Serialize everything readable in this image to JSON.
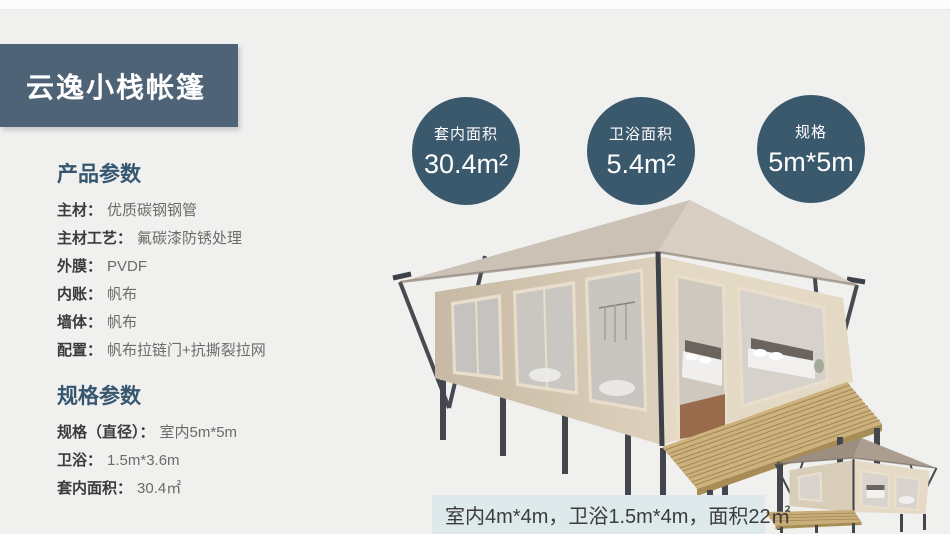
{
  "title": {
    "text": "云逸小栈帐篷"
  },
  "specs": {
    "sections": [
      {
        "heading": "产品参数",
        "rows": [
          {
            "label": "主材：",
            "value": "优质碳钢钢管"
          },
          {
            "label": "主材工艺：",
            "value": "氟碳漆防锈处理"
          },
          {
            "label": "外膜：",
            "value": "PVDF"
          },
          {
            "label": "内账：",
            "value": "帆布"
          },
          {
            "label": "墙体：",
            "value": "帆布"
          },
          {
            "label": "配置：",
            "value": "帆布拉链门+抗撕裂拉网"
          }
        ]
      },
      {
        "heading": "规格参数",
        "rows": [
          {
            "label": "规格（直径）：",
            "value": "室内5m*5m"
          },
          {
            "label": "卫浴：",
            "value": "1.5m*3.6m"
          },
          {
            "label": "套内面积：",
            "value": "30.4㎡"
          }
        ]
      }
    ]
  },
  "badges": {
    "items": [
      {
        "label": "套内面积",
        "value": "30.4m²"
      },
      {
        "label": "卫浴面积",
        "value": "5.4m²"
      },
      {
        "label": "规格",
        "value": "5m*5m"
      }
    ]
  },
  "caption": {
    "text": "室内4m*4m，卫浴1.5m*4m，面积22㎡"
  },
  "images": {
    "main_tent_alt": "大型野奢帐篷效果图",
    "small_tent_alt": "小型帐篷效果图"
  },
  "colors": {
    "title_bg": "#4e6375",
    "badge_bg": "#3b596d",
    "heading": "#36576f",
    "page_bg": "#f0f0ef",
    "caption_bg": "#dde9ea"
  }
}
